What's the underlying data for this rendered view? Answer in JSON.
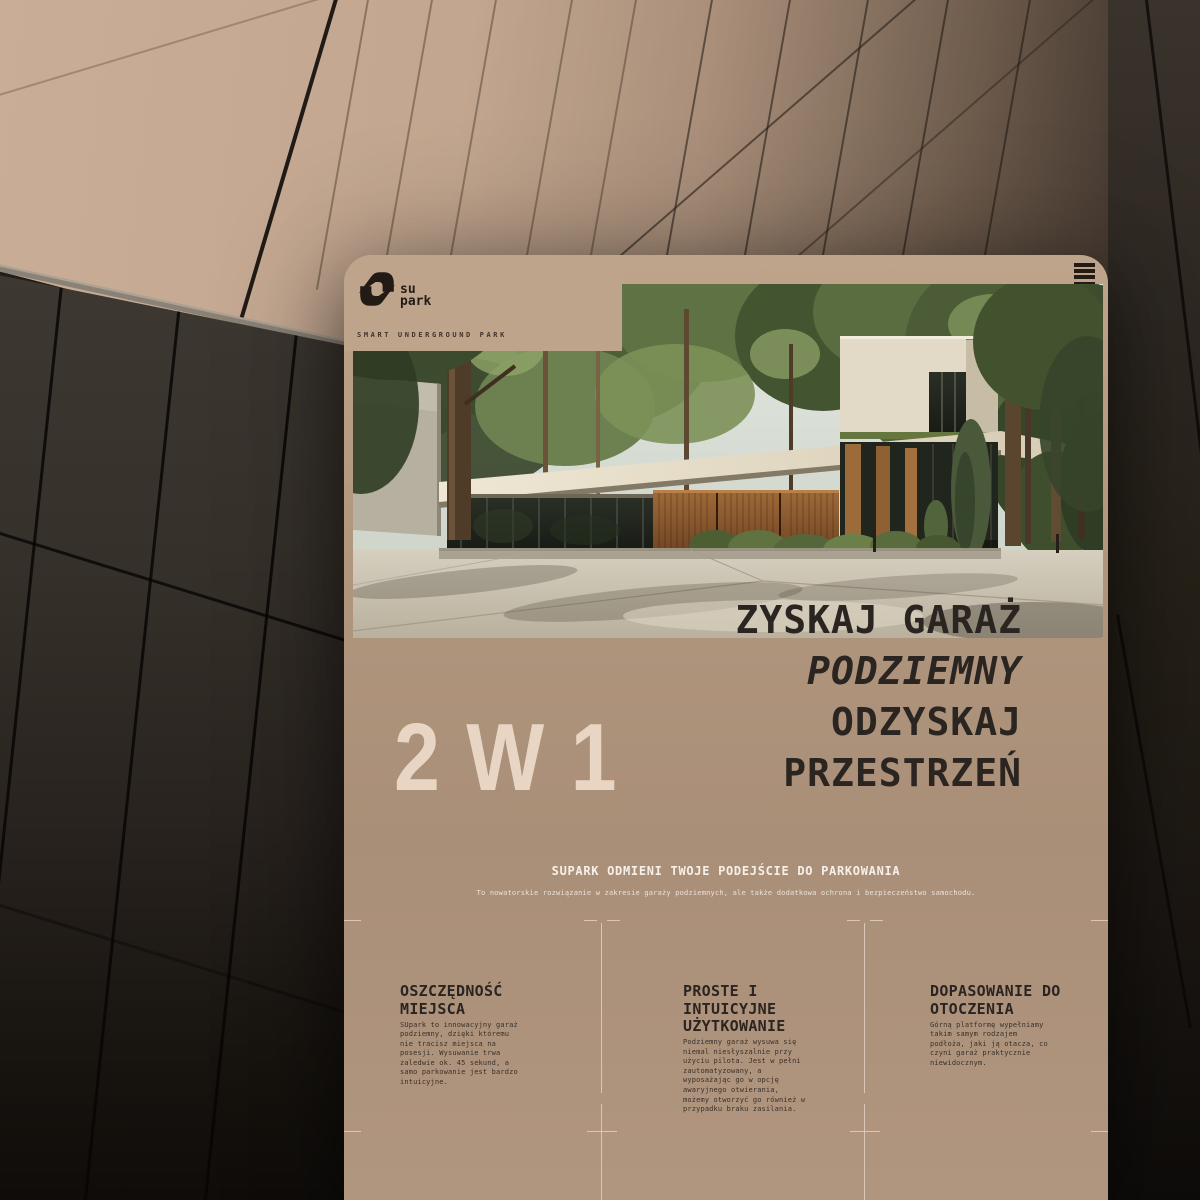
{
  "brand": {
    "logo_su": "su",
    "logo_park": "park",
    "tagline": "SMART UNDERGROUND PARK"
  },
  "nav": {
    "menu_icon": "hamburger"
  },
  "hero": {
    "heading_lines": [
      "ZYSKAJ GARAŻ",
      "PODZIEMNY",
      "ODZYSKAJ",
      "PRZESTRZEŃ"
    ],
    "heading_italic_index": 1,
    "badge": "2 W 1"
  },
  "intro": {
    "title": "SUPARK ODMIENI TWOJE PODEJŚCIE DO PARKOWANIA",
    "subtitle": "To nowatorskie rozwiązanie w zakresie garaży podziemnych, ale także dodatkowa ochrona i bezpieczeństwo samochodu."
  },
  "features": [
    {
      "title": "OSZCZĘDNOŚĆ\nMIEJSCA",
      "body": "SUpark to innowacyjny garaż\npodziemny, dzięki któremu\nnie tracisz miejsca na\nposesji. Wysuwanie trwa\nzaledwie ok. 45 sekund, a\nsamo parkowanie jest bardzo\nintuicyjne."
    },
    {
      "title": "PROSTE I\nINTUICYJNE\nUŻYTKOWANIE",
      "body": "Podziemny garaż wysuwa się\nniemal niesłyszalnie przy\nużyciu pilota. Jest w pełni\nzautomatyzowany, a\nwyposażając go w opcję\nawaryjnego otwierania,\nmożemy otworzyć go również w\nprzypadku braku zasilania."
    },
    {
      "title": "DOPASOWANIE DO\nOTOCZENIA",
      "body": "Górną platformę wypełniamy\ntakim samym rodzajem\npodłoża, jaki ją otacza, co\nczyni garaż praktycznie\nniewidocznym."
    }
  ],
  "colors": {
    "card_bg": "#b1967e",
    "accent_cream": "#e8d5c4",
    "text_dark": "#2b2521",
    "text_light": "#f7f0e8",
    "guide": "#dfccbc",
    "logo_dark": "#221b15"
  }
}
